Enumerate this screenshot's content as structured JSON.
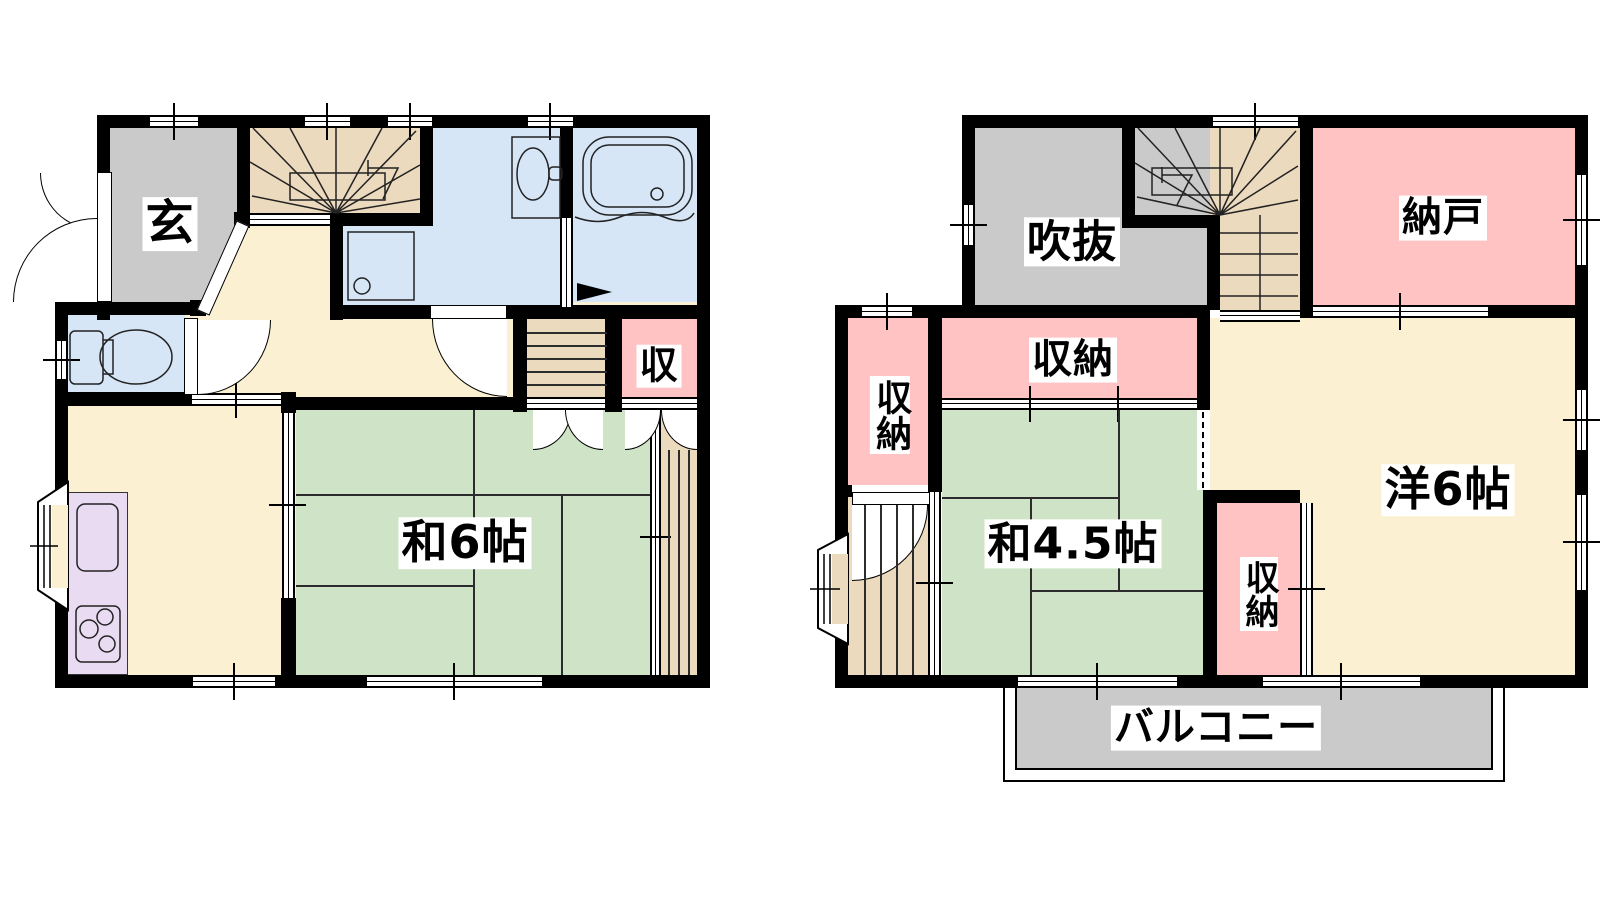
{
  "floor1": {
    "rooms": {
      "genkan": "玄",
      "tatami6": "和6帖",
      "storage": "収"
    }
  },
  "floor2": {
    "rooms": {
      "fukinuke": "吹抜",
      "nando": "納戸",
      "closet_top": "収納",
      "closet_left": "収納",
      "tatami45": "和4.5帖",
      "closet_small": "収納",
      "western6": "洋6帖",
      "balcony": "バルコニー"
    }
  },
  "colors": {
    "wall": "#000000",
    "hall": "#FBF0D2",
    "tatami": "#CFE4C7",
    "storage": "#FFC3C3",
    "gray": "#CACACA",
    "water": "#D6E6F7",
    "stairs": "#ECDABE",
    "counter": "#E8DBF2"
  }
}
